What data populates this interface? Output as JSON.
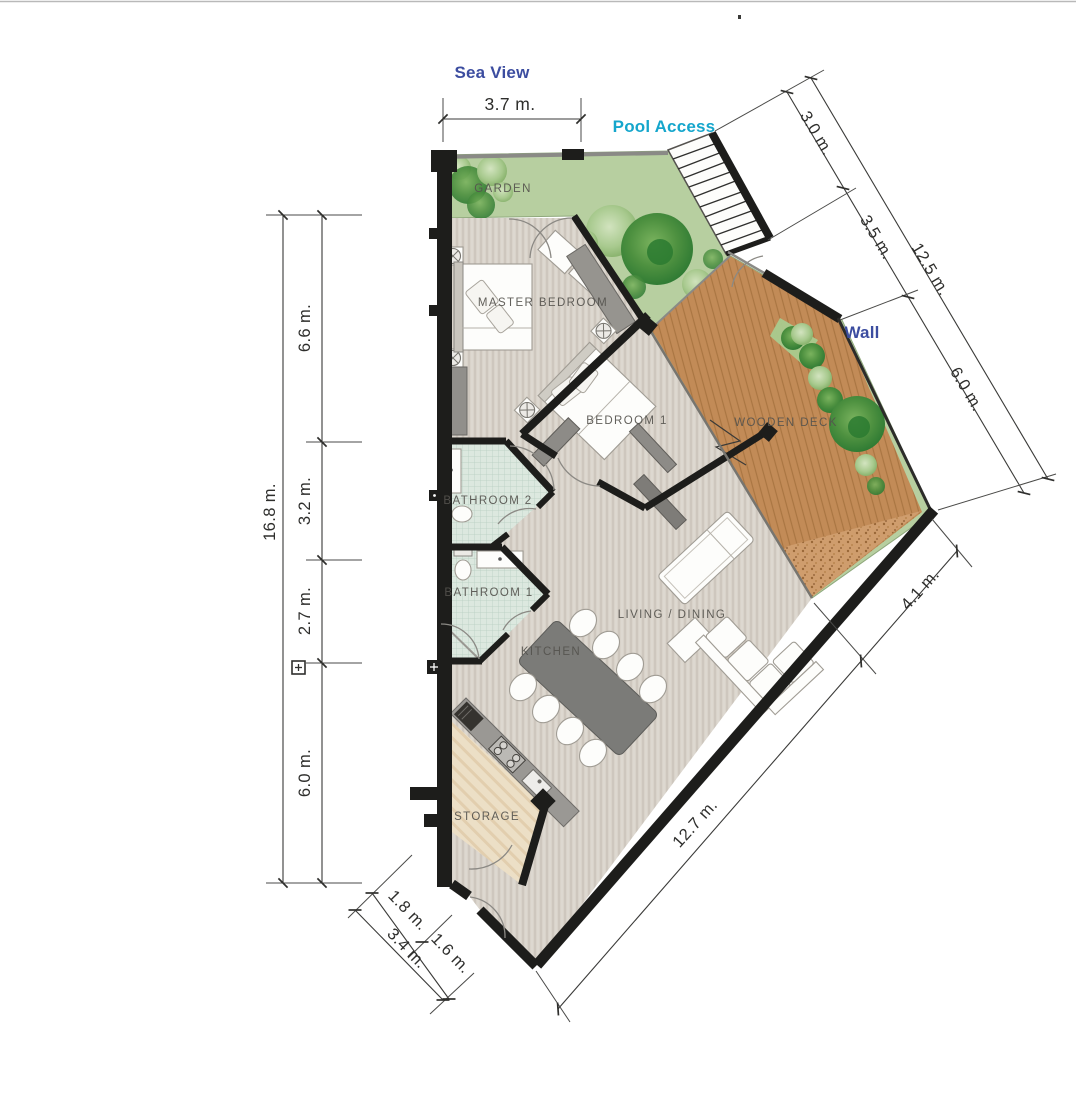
{
  "annotations": {
    "sea_view": "Sea View",
    "pool_access": "Pool Access",
    "wall": "Wall"
  },
  "rooms": {
    "garden": "GARDEN",
    "master_bedroom": "MASTER BEDROOM",
    "bedroom_1": "BEDROOM 1",
    "wooden_deck": "WOODEN DECK",
    "bathroom_2": "BATHROOM 2",
    "bathroom_1": "BATHROOM 1",
    "kitchen": "KITCHEN",
    "living_dining": "LIVING / DINING",
    "storage": "STORAGE"
  },
  "dimensions": {
    "top_width": "3.7 m.",
    "left": {
      "total": "16.8 m.",
      "segments": [
        "6.6 m.",
        "3.2 m.",
        "2.7 m.",
        "6.0 m."
      ]
    },
    "right": {
      "total": "12.5 m.",
      "segments": [
        "3.0 m.",
        "3.5 m.",
        "6.0 m."
      ]
    },
    "bottom_right": {
      "deck_edge": "4.1 m.",
      "main_edge": "12.7 m."
    },
    "bottom_left": {
      "total": "3.4 m.",
      "segments": [
        "1.8 m.",
        "1.6 m."
      ]
    }
  },
  "colors": {
    "garden": "#b7cfa0",
    "deck": "#c28b57",
    "gravel": "#cf9d6d",
    "floor": "#d9d3ca",
    "bathroom": "#dce8df",
    "storage": "#ecdfc6",
    "wall": "#1d1d1b",
    "label_blue": "#3c4da0",
    "label_cyan": "#15a6cc"
  }
}
